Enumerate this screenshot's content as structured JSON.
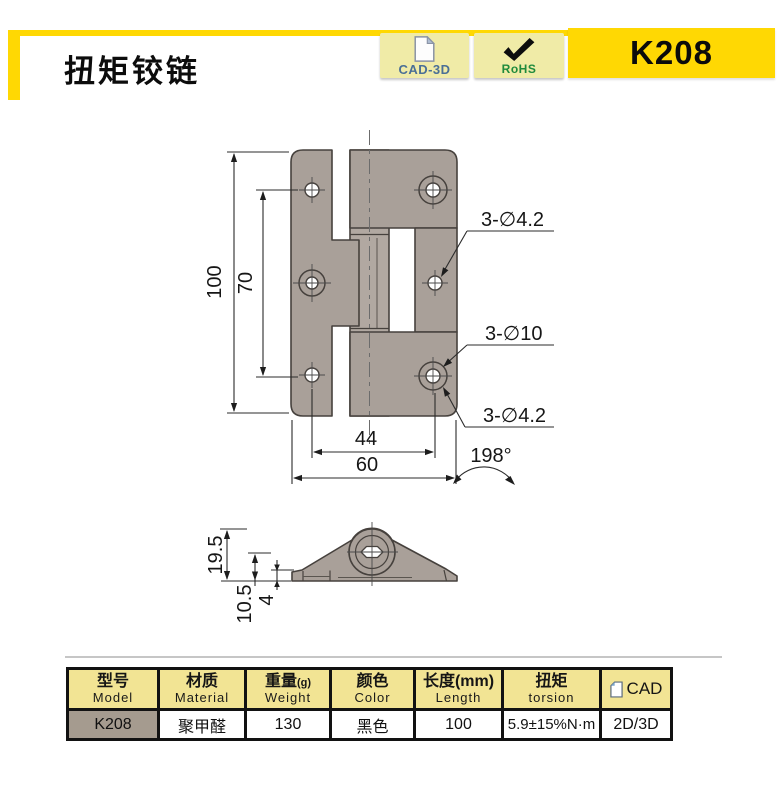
{
  "header": {
    "title": "扭矩铰链",
    "model_code": "K208",
    "badges": [
      {
        "label": "CAD-3D",
        "icon": "document-icon"
      },
      {
        "label": "RoHS",
        "icon": "checkmark-icon"
      }
    ],
    "colors": {
      "accent_yellow": "#FFD803",
      "badge_bg": "#F0EBA7",
      "cad_label_color": "#4A6F96",
      "rohs_label_color": "#1F8A3C"
    }
  },
  "drawing": {
    "colors": {
      "part_fill": "#A9A099",
      "outline": "#46413D"
    },
    "front_view": {
      "dim_height": "100",
      "dim_hole_pitch_v": "70",
      "dim_hole_pitch_h": "44",
      "dim_width": "60",
      "callout_top": "3-∅4.2",
      "callout_middle": "3-∅10",
      "callout_bottom": "3-∅4.2",
      "open_angle": "198°"
    },
    "side_view": {
      "dim_total_height": "19.5",
      "dim_pivot_height": "10.5",
      "dim_leaf_thickness": "4"
    }
  },
  "spec_table": {
    "columns": [
      {
        "cn": "型号",
        "en": "Model"
      },
      {
        "cn": "材质",
        "en": "Material"
      },
      {
        "cn": "重量",
        "suffix": "(g)",
        "en": "Weight"
      },
      {
        "cn": "颜色",
        "en": "Color"
      },
      {
        "cn": "长度(mm)",
        "en": "Length"
      },
      {
        "cn": "扭矩",
        "en": "torsion"
      },
      {
        "cn": "CAD",
        "en": ""
      }
    ],
    "row": {
      "model": "K208",
      "material": "聚甲醛",
      "weight": "130",
      "color": "黑色",
      "length": "100",
      "torsion": "5.9±15%N·m",
      "cad": "2D/3D"
    },
    "colors": {
      "header_bg": "#F2E494",
      "model_cell_bg": "#A59B8F"
    }
  }
}
